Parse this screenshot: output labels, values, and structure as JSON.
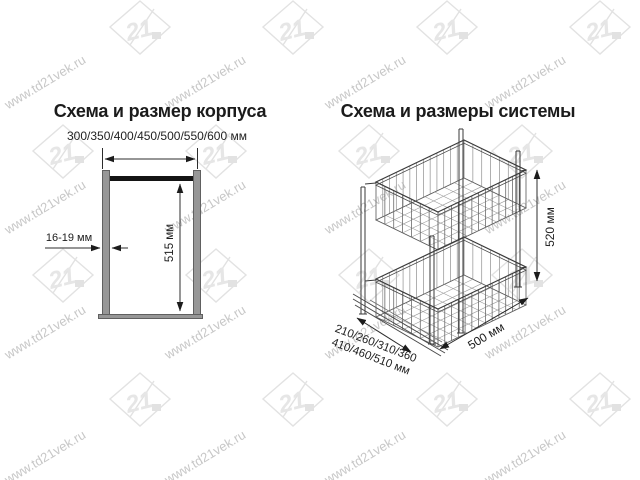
{
  "watermark": {
    "site_url": "www.td21vek.ru",
    "logo_number": "21"
  },
  "left_diagram": {
    "title": "Схема и размер корпуса",
    "cabinet_width_options": "300/350/400/450/500/550/600 мм",
    "panel_thickness_label": "16-19 мм",
    "inner_height_label": "515 мм"
  },
  "right_diagram": {
    "title": "Схема и размеры системы",
    "system_height_label": "520 мм",
    "system_depth_label": "500 мм",
    "system_width_options_line1": "210/260/310/360",
    "system_width_options_line2": "410/460/510 мм"
  },
  "colors": {
    "background": "#ffffff",
    "drawing_line": "#2c2c2c",
    "panel_gray": "#979797",
    "top_rail_black": "#141414",
    "watermark_text": "#c7c7c7",
    "watermark_logo": "#e2e2e2"
  }
}
